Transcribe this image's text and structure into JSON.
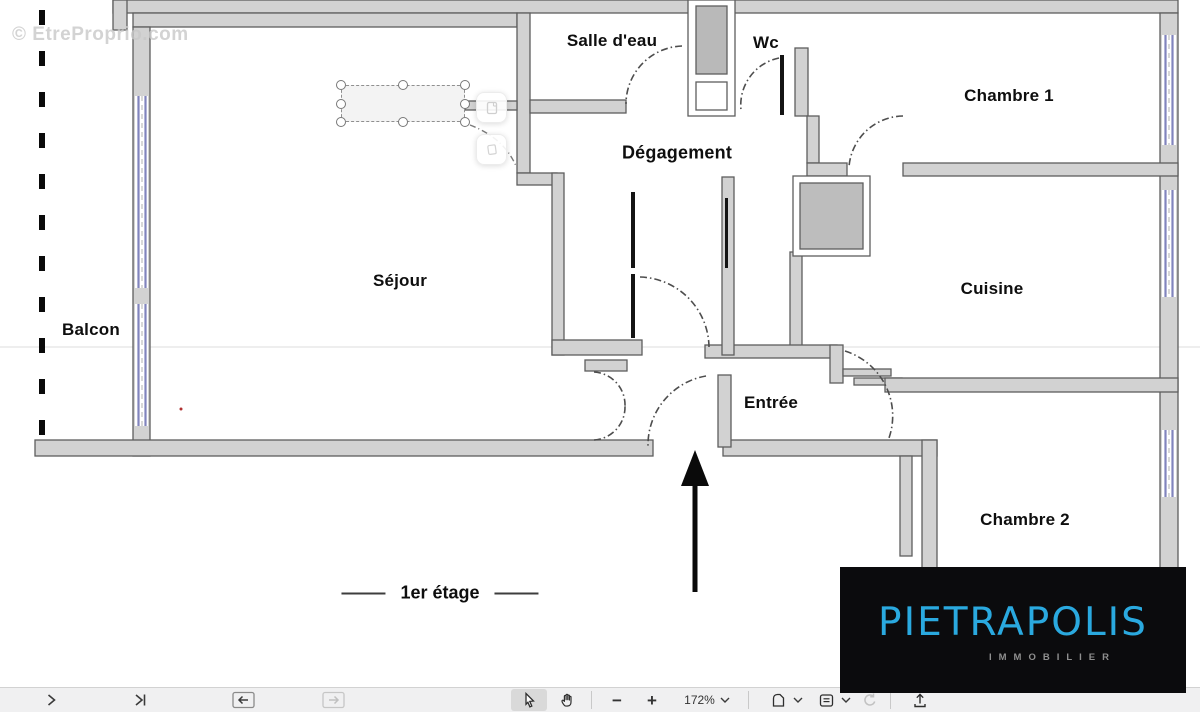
{
  "watermark": {
    "text": "© EtreProprio.com"
  },
  "plan": {
    "rooms": [
      {
        "id": "salle-deau",
        "label": "Salle d'eau"
      },
      {
        "id": "wc",
        "label": "Wc"
      },
      {
        "id": "chambre1",
        "label": "Chambre 1"
      },
      {
        "id": "degagement",
        "label": "Dégagement"
      },
      {
        "id": "sejour",
        "label": "Séjour"
      },
      {
        "id": "cuisine",
        "label": "Cuisine"
      },
      {
        "id": "balcon",
        "label": "Balcon"
      },
      {
        "id": "entree",
        "label": "Entrée"
      },
      {
        "id": "chambre2",
        "label": "Chambre 2"
      }
    ],
    "floor_label": "1er étage"
  },
  "logo": {
    "brand": "PIETRAPOLIS",
    "tagline": "IMMOBILIER",
    "brand_color": "#2aa9df",
    "background": "#0b0b0d"
  },
  "toolbar": {
    "zoom_level": "172%",
    "zoom_out_label": "−",
    "zoom_in_label": "+",
    "icons": [
      "next-page",
      "last-page",
      "previous-view",
      "next-view",
      "select-tool",
      "hand-tool",
      "zoom-out",
      "zoom-in",
      "zoom-level-dropdown",
      "fit-page",
      "page-display",
      "rotate",
      "upload"
    ]
  },
  "colors": {
    "wall_fill": "#d2d2d2",
    "wall_stroke": "#5e5e5e",
    "window": "#8184bd",
    "toolbar_bg": "#f0f0f1",
    "annotation_handle_border": "#777777"
  }
}
